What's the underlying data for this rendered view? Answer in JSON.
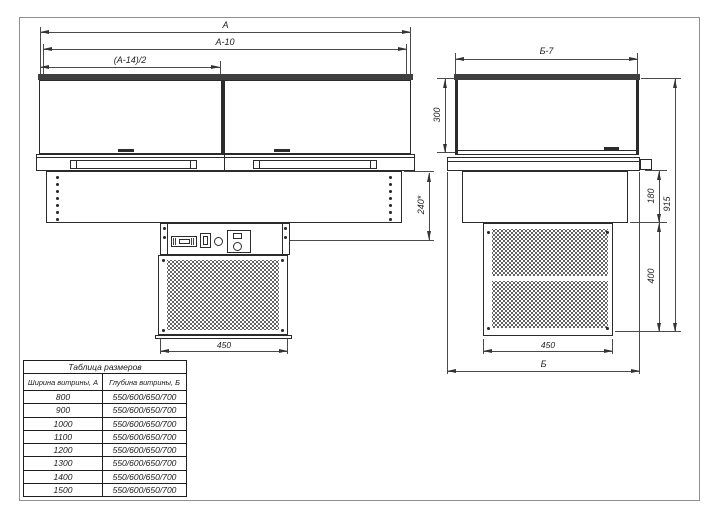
{
  "front_view": {
    "dim_width": "А",
    "dim_width_minus10": "А-10",
    "dim_half_width": "(А-14)/2",
    "dim_mount_depth": "240*",
    "dim_grille_width": "450"
  },
  "side_view": {
    "dim_depth_minus7": "Б-7",
    "dim_glass_height": "300",
    "dim_body_height": "180",
    "dim_condenser_height": "400",
    "dim_total_height": "915",
    "dim_grille_width": "450",
    "dim_depth": "Б"
  },
  "size_table": {
    "title": "Таблица размеров",
    "col_width": "Ширина витрины, А",
    "col_depth": "Глубина витрины, Б",
    "rows": [
      {
        "width": "800",
        "depth": "550/600/650/700"
      },
      {
        "width": "900",
        "depth": "550/600/650/700"
      },
      {
        "width": "1000",
        "depth": "550/600/650/700"
      },
      {
        "width": "1100",
        "depth": "550/600/650/700"
      },
      {
        "width": "1200",
        "depth": "550/600/650/700"
      },
      {
        "width": "1300",
        "depth": "550/600/650/700"
      },
      {
        "width": "1400",
        "depth": "550/600/650/700"
      },
      {
        "width": "1500",
        "depth": "550/600/650/700"
      }
    ]
  },
  "colors": {
    "line": "#2b2b2b",
    "dimension": "#4a4a4a",
    "frame_border": "#8f8f8f"
  }
}
